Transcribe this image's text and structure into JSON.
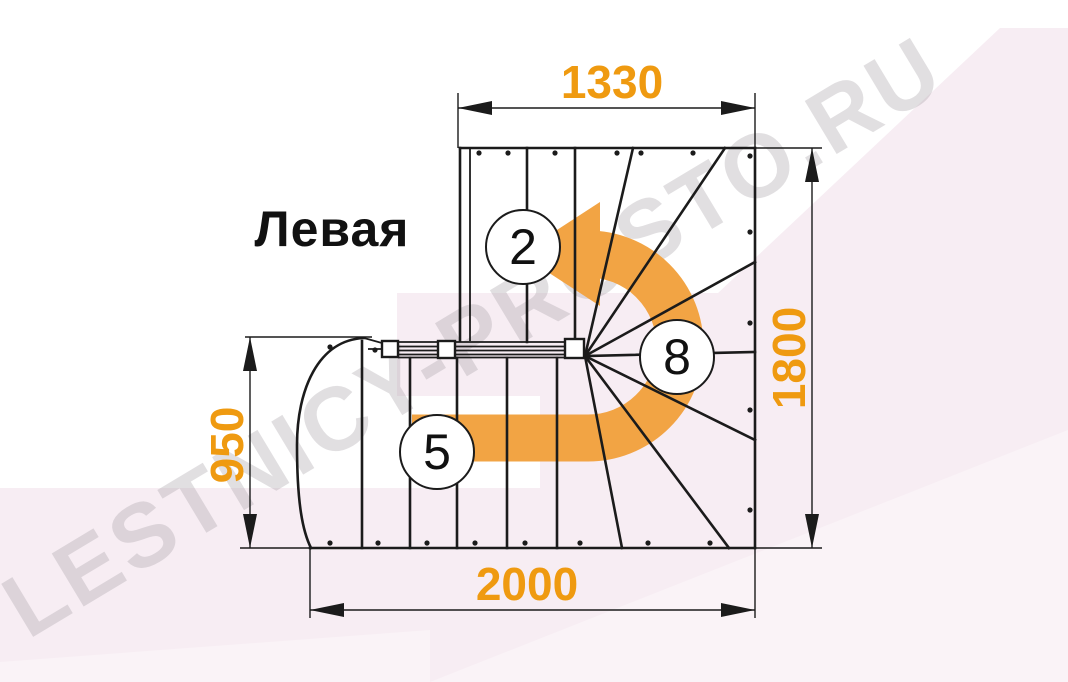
{
  "diagram": {
    "orientation_label": "Левая",
    "watermark": "LESTNICY-PROSTO.RU",
    "dimensions": {
      "top": {
        "value": "1330"
      },
      "right": {
        "value": "1800"
      },
      "left": {
        "value": "950"
      },
      "bottom": {
        "value": "2000"
      }
    },
    "step_badges": [
      {
        "id": "upper-flight",
        "value": "2"
      },
      {
        "id": "winder",
        "value": "8"
      },
      {
        "id": "lower-flight",
        "value": "5"
      }
    ]
  },
  "colors": {
    "accent": "#ef9a10",
    "arrow": "#f2a444",
    "line": "#1b1b1b",
    "pink": "#f7edf3",
    "pink_light": "#faf3f7",
    "watermark": "#a8a0a6"
  }
}
